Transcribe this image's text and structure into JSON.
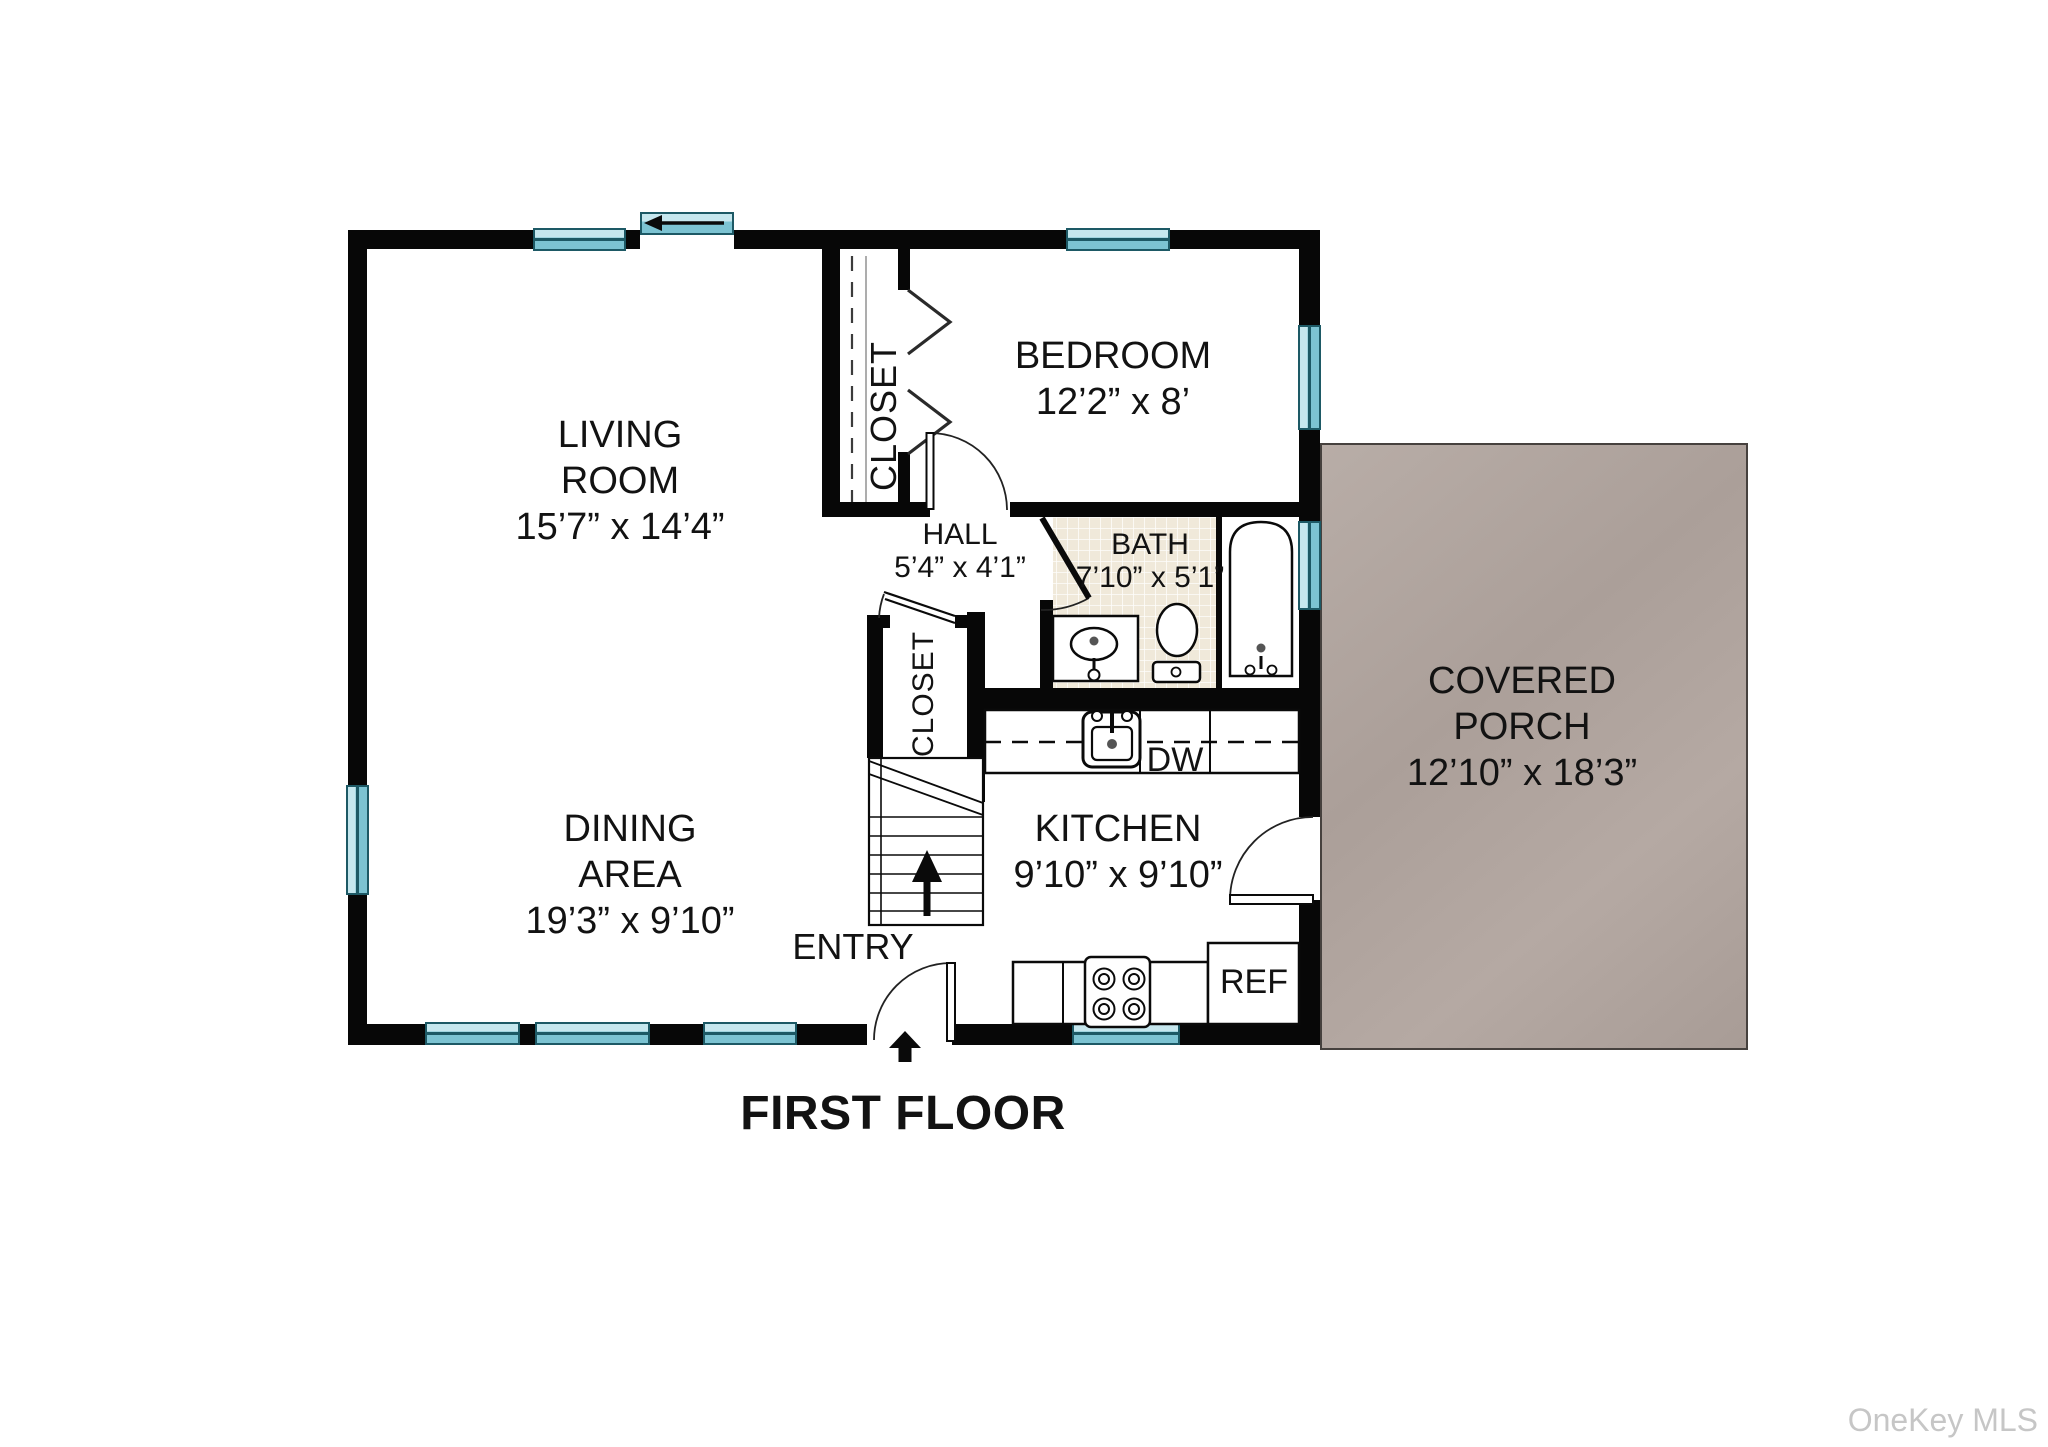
{
  "title": "FIRST FLOOR",
  "watermark": "OneKey MLS",
  "colors": {
    "wall": "#070707",
    "window_teal": "#7cc3d2",
    "window_border": "#1d5965",
    "porch_fill": "#b0a49e",
    "bath_tile": "#f0e9da",
    "text": "#121212",
    "watermark_gray": "#c6c6c6"
  },
  "rooms": {
    "living_room": {
      "name_line1": "LIVING",
      "name_line2": "ROOM",
      "dimensions": "15’7” x 14’4”"
    },
    "dining_area": {
      "name_line1": "DINING",
      "name_line2": "AREA",
      "dimensions": "19’3” x 9’10”"
    },
    "bedroom": {
      "name": "BEDROOM",
      "dimensions": "12’2” x 8’"
    },
    "bathroom": {
      "name": "BATH",
      "dimensions": "7’10” x 5’1”"
    },
    "hall": {
      "name": "HALL",
      "dimensions": "5’4” x 4’1”"
    },
    "kitchen": {
      "name": "KITCHEN",
      "dimensions": "9’10” x 9’10”"
    },
    "covered_porch": {
      "name_line1": "COVERED",
      "name_line2": "PORCH",
      "dimensions": "12’10” x 18’3”"
    },
    "bedroom_closet": {
      "name": "CLOSET"
    },
    "entry_closet": {
      "name": "CLOSET"
    },
    "entry": {
      "name": "ENTRY"
    }
  },
  "appliances": {
    "dishwasher_label": "DW",
    "refrigerator_label": "REF"
  }
}
